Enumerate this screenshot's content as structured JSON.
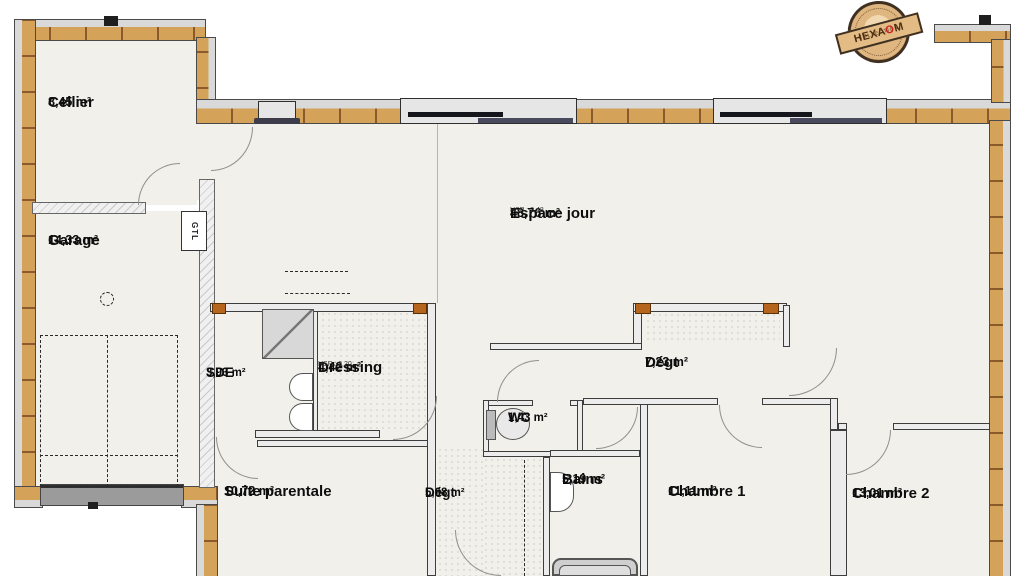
{
  "plan": {
    "rooms": [
      {
        "name": "Cellier",
        "area": "8,45 m²"
      },
      {
        "name": "Garage",
        "area": "14,33 m²"
      },
      {
        "name": "Espace jour",
        "area": "48,76 m²",
        "hsp": "HSP : 2,48"
      },
      {
        "name": "SDE",
        "area": "3,93 m²"
      },
      {
        "name": "Dressing",
        "area": "4,42 m²",
        "hsp": "HSP : 2,20"
      },
      {
        "name": "Dégt",
        "area": "7,23 m²"
      },
      {
        "name": "WC",
        "area": "1,43 m²"
      },
      {
        "name": "Bains",
        "area": "5,19 m²"
      },
      {
        "name": "Chambre 1",
        "area": "11,11 m²"
      },
      {
        "name": "Chambre 2",
        "area": "13,01 m²"
      },
      {
        "name": "Suite parentale",
        "area": "10,72 m²"
      },
      {
        "name": "Dégt",
        "area": "5,68 m²"
      }
    ],
    "annotations": {
      "gtl": "GTL"
    },
    "logo": {
      "collection": "collection",
      "brand_pre": "HEXA",
      "brand_o": "O",
      "brand_post": "M"
    },
    "colors": {
      "wood": "#d4a258",
      "wood_line": "#8a5a2c",
      "outer_band": "#d9d9d9",
      "floor": "#f1f0ea",
      "window_dark": "#34343f",
      "lintel": "#b5651d",
      "accent_red": "#cc2222"
    }
  }
}
